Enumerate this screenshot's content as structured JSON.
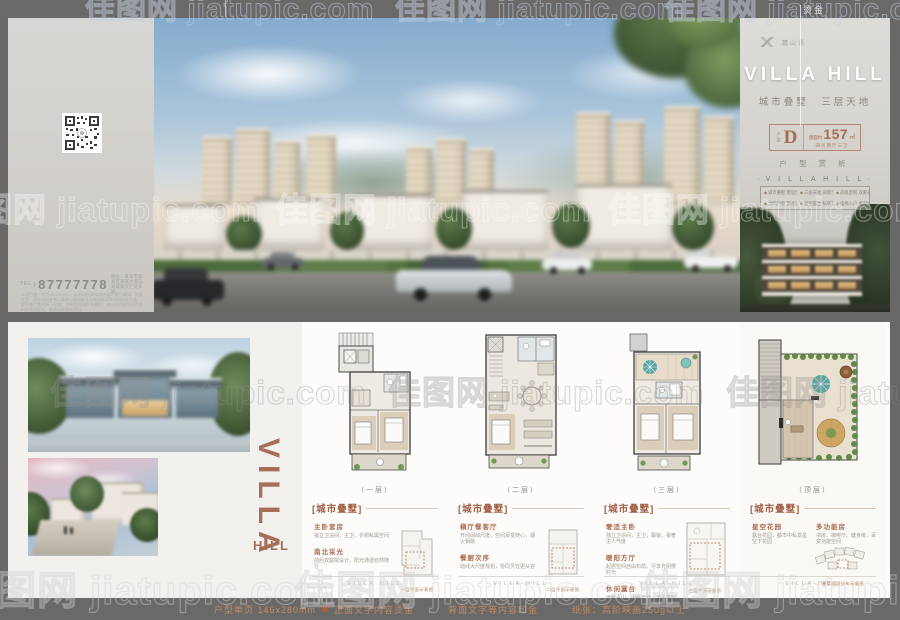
{
  "bars": {
    "top_label": "烫金",
    "spec": {
      "item": "户型单页 146x280mm",
      "front": "正面文字内容烫金",
      "back": "背面文字等内容印金",
      "paper": "纸张：高阶映画250g以上"
    }
  },
  "watermark": {
    "text": "佳图网 jiatupic.com"
  },
  "front": {
    "brand": {
      "name": "麓山语"
    },
    "title": "VILLA HILL",
    "subtitle": "城市叠墅　三层天地",
    "unit": {
      "label": "户型",
      "letter": "D",
      "area_prefix": "建面约",
      "area": "157",
      "area_unit": "㎡",
      "layout": "四房两厅三卫"
    },
    "caption": "户 型 赏 析",
    "features": {
      "title": "V I L L A   H I L L",
      "items": [
        {
          "text": "城市叠墅 墅居生活"
        },
        {
          "text": "三层天地 阔景空间"
        },
        {
          "text": "前庭后院 双重礼序"
        },
        {
          "text": "全明户型 南北通透"
        },
        {
          "text": "星空露台 私属花园"
        },
        {
          "text": "电梯入户 尊崇归家"
        }
      ]
    }
  },
  "back": {
    "tel_label": "TEL",
    "phone": "87777778",
    "address": "地址：某某市某某区某某大道与某某路交汇处东侧",
    "note1": "本项目推广名为VILLA HILL，本资料所发布的内容为要约邀请，相关文字、图片仅供参考，最终以政府批文及商品房买卖合同约定为准。",
    "note2": "部分图片素材源于网络，如有侵权请联系删除；本公司保留对宣传资料修改的权利，敬请留意最新资料。"
  },
  "bottom_left": {
    "brand_main": "VILLA",
    "brand_sub": "HILL"
  },
  "plans": [
    {
      "caption": "（一层）",
      "tag": "[城市叠墅]",
      "blocks": [
        {
          "h": "主卧套房",
          "d": "独立卫浴间，主卫，衣帽私属空间"
        },
        {
          "h": "南北采光",
          "d": "前后双庭院设计，阳光通透自然随行"
        }
      ],
      "keynote": "一层平面示意图",
      "footer": "VILLA HILL"
    },
    {
      "caption": "（二层）",
      "tag": "[城市叠墅]",
      "blocks": [
        {
          "h": "横厅餐客厅",
          "d": "开间阔绰尺度，空间百变随心，烟火相融"
        },
        {
          "h": "餐厨次序",
          "d": "动线大尺度规划，协同烹饪更从容"
        }
      ],
      "keynote": "二层平面示意图",
      "footer": "VILLA HILL"
    },
    {
      "caption": "（三层）",
      "tag": "[城市叠墅]",
      "blocks": [
        {
          "h": "奢适主卧",
          "d": "独立卫浴间，主卫，飘窗，豪奢主人气度"
        },
        {
          "h": "暖阳方厅",
          "d": "起居空间自由布局，尽享光阴慢时光"
        },
        {
          "h": "休闲露台",
          "d": "远眺青山，闲看云舒，下午茶时光，惬意天地"
        }
      ],
      "keynote": "三层平面示意图",
      "footer": "VILLA HILL"
    },
    {
      "caption": "（顶层）",
      "tag": "[城市叠墅]",
      "blocks": [
        {
          "h": "星空花园",
          "d": "露台花园，都市中私享星空下花园"
        },
        {
          "h": "多功能房",
          "d": "书房、咖啡厅、健身房，百变功能空间"
        }
      ],
      "keynote": "叠墅组团分布示意图",
      "footer": "VILLA HILL"
    }
  ],
  "compass": {
    "label": "N"
  }
}
